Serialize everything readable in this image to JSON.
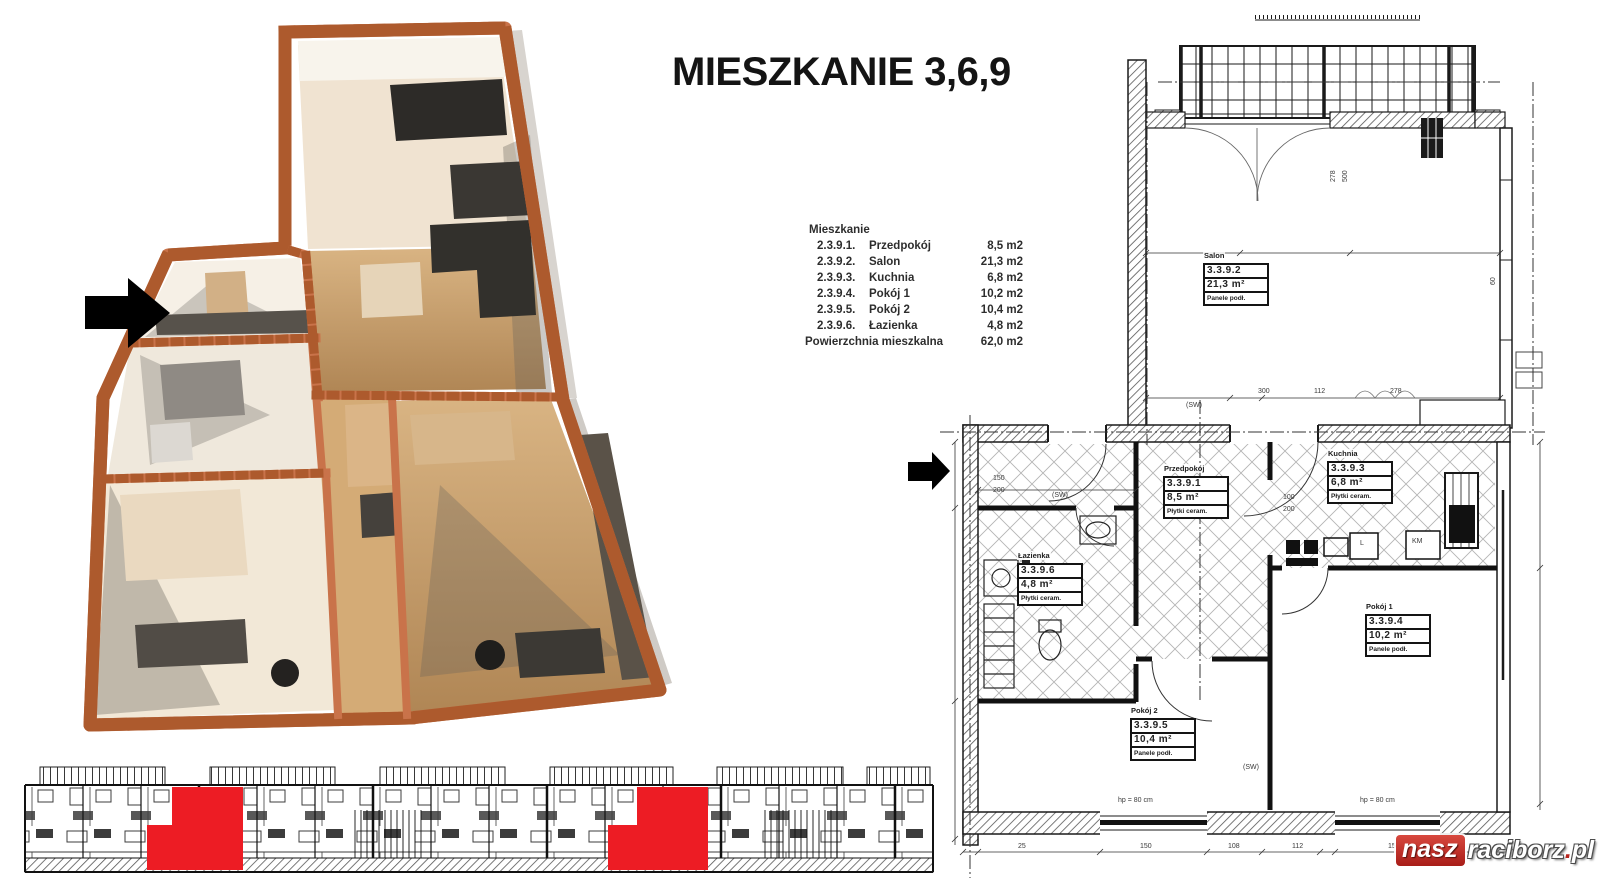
{
  "title": "MIESZKANIE 3,6,9",
  "room_list": {
    "header": "Mieszkanie",
    "rows": [
      {
        "code": "2.3.9.1.",
        "name": "Przedpokój",
        "area": "8,5 m2"
      },
      {
        "code": "2.3.9.2.",
        "name": "Salon",
        "area": "21,3 m2"
      },
      {
        "code": "2.3.9.3.",
        "name": "Kuchnia",
        "area": "6,8 m2"
      },
      {
        "code": "2.3.9.4.",
        "name": "Pokój 1",
        "area": "10,2 m2"
      },
      {
        "code": "2.3.9.5.",
        "name": "Pokój 2",
        "area": "10,4 m2"
      },
      {
        "code": "2.3.9.6.",
        "name": "Łazienka",
        "area": "4,8 m2"
      }
    ],
    "footer_label": "Powierzchnia mieszkalna",
    "footer_value": "62,0 m2"
  },
  "plan_labels": [
    {
      "name": "Salon",
      "code": "3.3.9.2",
      "area": "21,3 m²",
      "floor": "Panele podł.",
      "x": 1203,
      "y": 245
    },
    {
      "name": "Przedpokój",
      "code": "3.3.9.1",
      "area": "8,5 m²",
      "floor": "Płytki ceram.",
      "x": 1163,
      "y": 458
    },
    {
      "name": "Kuchnia",
      "code": "3.3.9.3",
      "area": "6,8 m²",
      "floor": "Płytki ceram.",
      "x": 1327,
      "y": 443
    },
    {
      "name": "Łazienka",
      "code": "3.3.9.6",
      "area": "4,8 m²",
      "floor": "Płytki ceram.",
      "x": 1017,
      "y": 545
    },
    {
      "name": "Pokój 1",
      "code": "3.3.9.4",
      "area": "10,2 m²",
      "floor": "Panele podł.",
      "x": 1365,
      "y": 596
    },
    {
      "name": "Pokój 2",
      "code": "3.3.9.5",
      "area": "10,4 m²",
      "floor": "Panele podł.",
      "x": 1130,
      "y": 700
    }
  ],
  "annotations": [
    {
      "text": "hp = 80 cm",
      "x": 1118,
      "y": 797
    },
    {
      "text": "hp = 80 cm",
      "x": 1360,
      "y": 797
    },
    {
      "text": "(SW)",
      "x": 1052,
      "y": 492
    },
    {
      "text": "(SW)",
      "x": 1186,
      "y": 402
    },
    {
      "text": "(SW)",
      "x": 1243,
      "y": 764
    },
    {
      "text": "150",
      "x": 993,
      "y": 475
    },
    {
      "text": "200",
      "x": 993,
      "y": 487
    },
    {
      "text": "100",
      "x": 1283,
      "y": 494
    },
    {
      "text": "200",
      "x": 1283,
      "y": 506
    },
    {
      "text": "300",
      "x": 1258,
      "y": 388
    },
    {
      "text": "112",
      "x": 1314,
      "y": 388
    },
    {
      "text": "278",
      "x": 1390,
      "y": 388
    },
    {
      "text": "25",
      "x": 1018,
      "y": 843
    },
    {
      "text": "150",
      "x": 1140,
      "y": 843
    },
    {
      "text": "108",
      "x": 1228,
      "y": 843
    },
    {
      "text": "112",
      "x": 1292,
      "y": 843
    },
    {
      "text": "150",
      "x": 1388,
      "y": 843
    },
    {
      "text": "L",
      "x": 1360,
      "y": 540
    },
    {
      "text": "KM",
      "x": 1412,
      "y": 538
    },
    {
      "text": "278",
      "x": 1330,
      "y": 182,
      "rot": -90
    },
    {
      "text": "500",
      "x": 1342,
      "y": 182,
      "rot": -90
    },
    {
      "text": "60",
      "x": 1490,
      "y": 285,
      "rot": -90
    }
  ],
  "watermark": {
    "prefix": "nasz",
    "main": "raciborz",
    "dot": ".",
    "suffix": "pl"
  },
  "colors": {
    "highlight": "#ed1c24",
    "wall_orange": "#c9734a",
    "logo_red": "#a81d18"
  }
}
